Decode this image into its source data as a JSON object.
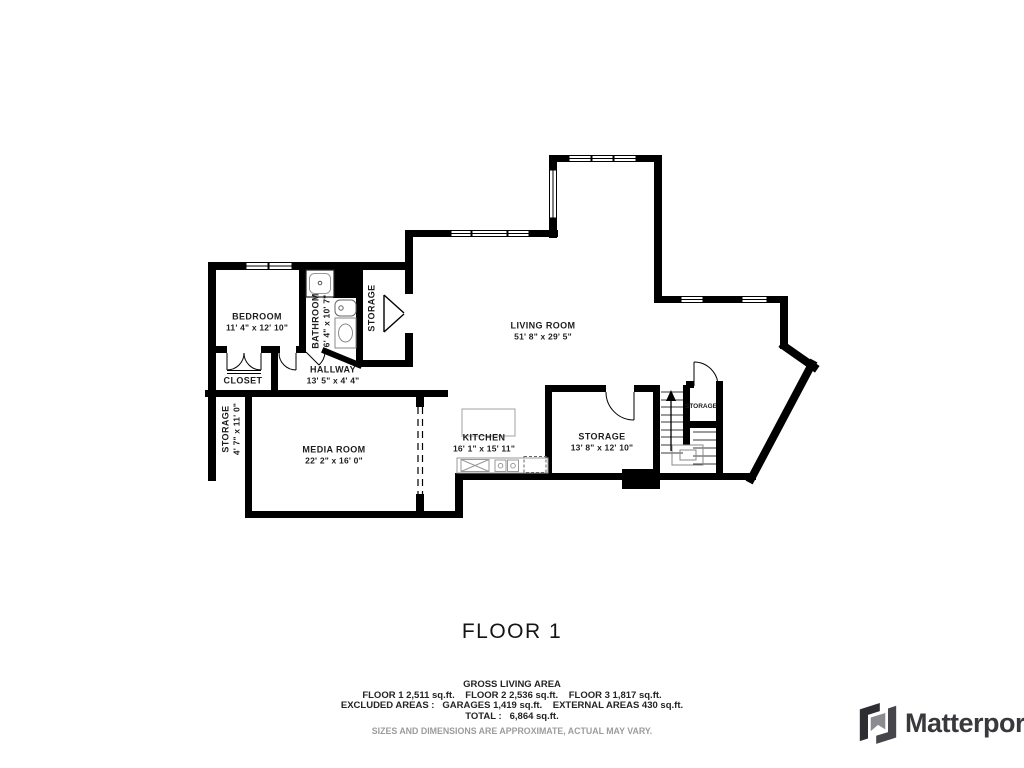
{
  "floor": {
    "title": "FLOOR 1"
  },
  "rooms": {
    "bedroom": {
      "name": "BEDROOM",
      "dims": "11' 4\" x 12' 10\""
    },
    "bathroom": {
      "name": "BATHROOM",
      "dims": "6' 4\" x 10' 7\""
    },
    "storage_upper": {
      "name": "STORAGE"
    },
    "living_room": {
      "name": "LIVING ROOM",
      "dims": "51' 8\" x 29' 5\""
    },
    "closet": {
      "name": "CLOSET"
    },
    "hallway": {
      "name": "HALLWAY",
      "dims": "13' 5\" x 4' 4\""
    },
    "storage_left": {
      "name": "STORAGE",
      "dims": "4' 7\" x 11' 0\""
    },
    "media_room": {
      "name": "MEDIA ROOM",
      "dims": "22' 2\" x 16' 0\""
    },
    "kitchen": {
      "name": "KITCHEN",
      "dims": "16' 1\" x 15' 11\""
    },
    "storage_main": {
      "name": "STORAGE",
      "dims": "13' 8\" x 12' 10\""
    },
    "storage_stair": {
      "name": "STORAGE"
    }
  },
  "summary": {
    "gross_label": "GROSS LIVING AREA",
    "floors_line": "FLOOR 1 2,511 sq.ft.    FLOOR 2 2,536 sq.ft.    FLOOR 3 1,817 sq.ft.",
    "excluded_line": "EXCLUDED AREAS :   GARAGES 1,419 sq.ft.    EXTERNAL AREAS 430 sq.ft.",
    "total_line": "TOTAL :   6,864 sq.ft.",
    "disclaimer": "SIZES AND DIMENSIONS ARE APPROXIMATE, ACTUAL MAY VARY."
  },
  "branding": {
    "logo_text": "Matterport"
  },
  "colors": {
    "walls": "#000000",
    "labels": "#1d1d1d",
    "disclaimer": "#9c9c9c",
    "logo": "#38383d"
  }
}
